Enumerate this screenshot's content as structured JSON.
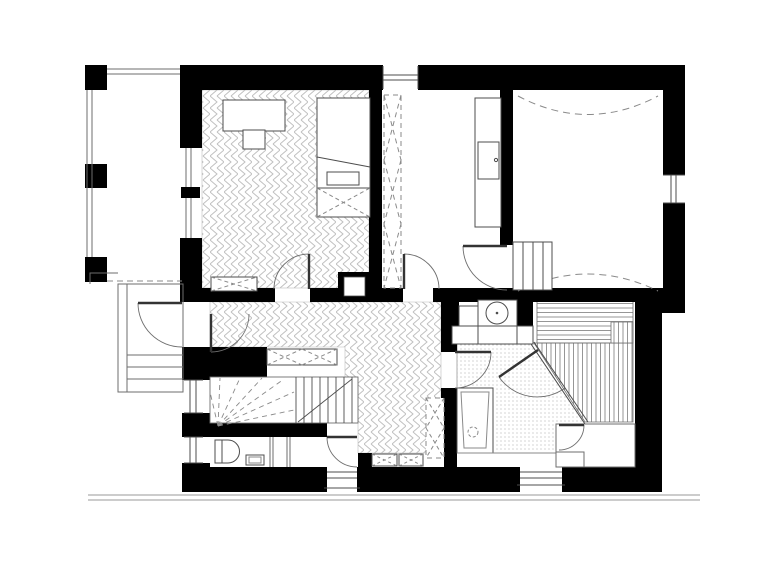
{
  "drawing": {
    "type": "architectural-floor-plan",
    "storey": "attic-level apartment plan",
    "rooms": [
      {
        "name": "balcony",
        "floor": "plain"
      },
      {
        "name": "bedroom",
        "floor": "herringbone-parquet"
      },
      {
        "name": "study-room",
        "floor": "plain"
      },
      {
        "name": "large-attic-room",
        "floor": "plain",
        "note": "dashed headroom curves"
      },
      {
        "name": "hallway",
        "floor": "herringbone-parquet"
      },
      {
        "name": "bathroom",
        "floor": "mosaic-dots"
      },
      {
        "name": "sauna",
        "floor": "wood-slats"
      },
      {
        "name": "wc",
        "floor": "plain"
      }
    ],
    "fixtures": [
      "desk",
      "chair",
      "bed",
      "storage-chest",
      "wardrobe",
      "radiator",
      "washbasin",
      "bathtub",
      "toilet",
      "hand-sink",
      "sauna-bench",
      "winder-staircase",
      "steps",
      "entry-stairs"
    ]
  },
  "palette": {
    "bg": "#ffffff",
    "wall": "#000000",
    "line": "#4d4d4d",
    "thin": "#6e6e6e",
    "hatch": "#c0c0c0",
    "dash": "#8a8a8a",
    "ground": "#9a9a9a"
  }
}
